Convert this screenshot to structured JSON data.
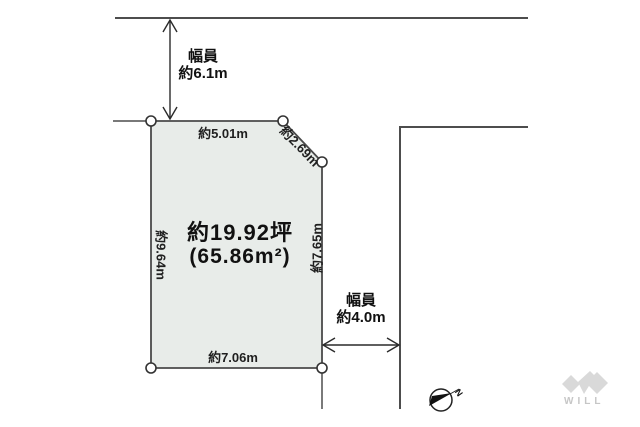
{
  "diagram": {
    "plot": {
      "area_line1": "約19.92坪",
      "area_line2": "(65.86m²)"
    },
    "dimensions": {
      "top": "約5.01m",
      "diagonal": "約2.69m",
      "left": "約9.64m",
      "right": "約7.65m",
      "bottom": "約7.06m"
    },
    "road_width_top": {
      "line1": "幅員",
      "line2": "約6.1m"
    },
    "road_width_right": {
      "line1": "幅員",
      "line2": "約4.0m"
    }
  },
  "compass": {
    "north_label": "N"
  },
  "logo": {
    "text": "WILL"
  },
  "colors": {
    "plot_fill": "#e8ece9",
    "plot_stroke": "#4a4a4a",
    "road_line": "#4d4d4d",
    "arrow": "#2a2a2a",
    "needle": "#111111",
    "logo_gray": "#d9d9d9"
  }
}
